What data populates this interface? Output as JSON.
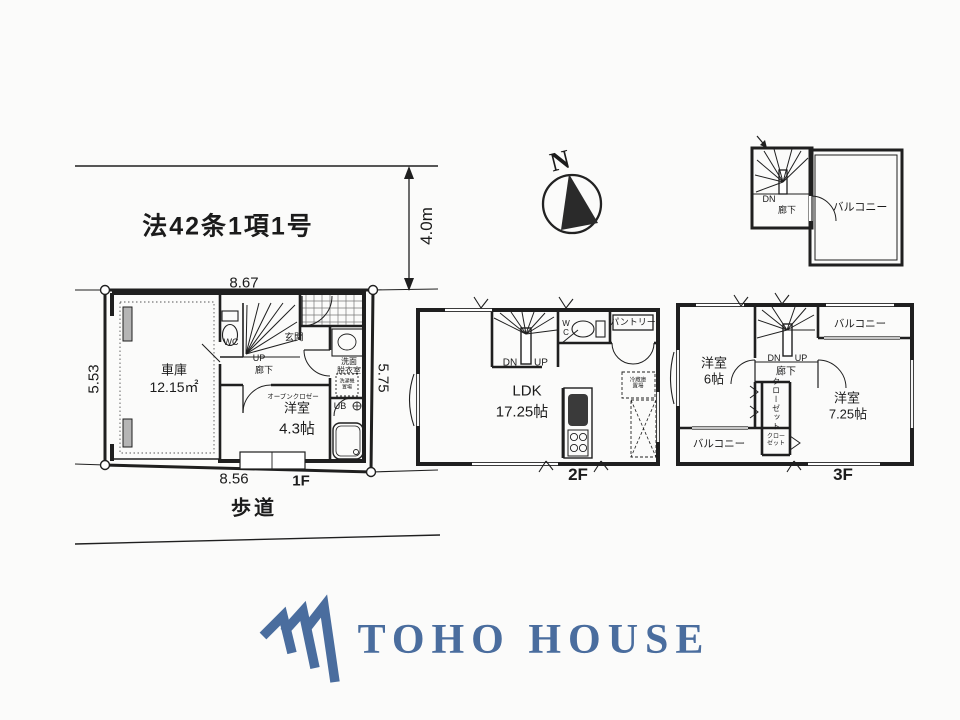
{
  "site": {
    "regulation": "法42条1項1号",
    "road_width": "4.0m",
    "dim_top": "8.67",
    "dim_left": "5.53",
    "dim_right": "5.75",
    "dim_bottom": "8.56",
    "sidewalk": "歩道",
    "north_label": "N"
  },
  "floor1": {
    "label": "1F",
    "garage": "車庫",
    "garage_area": "12.15㎡",
    "wc": "WC",
    "up": "UP",
    "hallway": "廊下",
    "entrance": "玄関",
    "washroom_line1": "洗面",
    "washroom_line2": "脱衣室",
    "laundry_line1": "洗濯機",
    "laundry_line2": "置場",
    "open_closet": "オープンクロゼー",
    "bedroom": "洋室",
    "bedroom_area": "4.3帖",
    "unit_bath": "UB"
  },
  "floor2": {
    "label": "2F",
    "dn": "DN",
    "up": "UP",
    "wc_line1": "W",
    "wc_line2": "C",
    "pantry": "パントリー",
    "ldk": "LDK",
    "ldk_area": "17.25帖",
    "fridge_line1": "冷蔵庫",
    "fridge_line2": "置場"
  },
  "floor3": {
    "label": "3F",
    "dn": "DN",
    "up": "UP",
    "hallway": "廊下",
    "bedroom1": "洋室",
    "bedroom1_area": "6帖",
    "bedroom2": "洋室",
    "bedroom2_area": "7.25帖",
    "balcony_top": "バルコニー",
    "balcony_bottom": "バルコニー",
    "closet_vertical": "クローゼット",
    "closet_line1": "クロー",
    "closet_line2": "ゼット"
  },
  "roof": {
    "dn": "DN",
    "hallway": "廊下",
    "balcony": "バルコニー"
  },
  "logo": {
    "text": "TOHO HOUSE",
    "color": "#4a6d9e"
  },
  "colors": {
    "line": "#1f1f1f",
    "logo_blue": "#4a6d9e"
  }
}
